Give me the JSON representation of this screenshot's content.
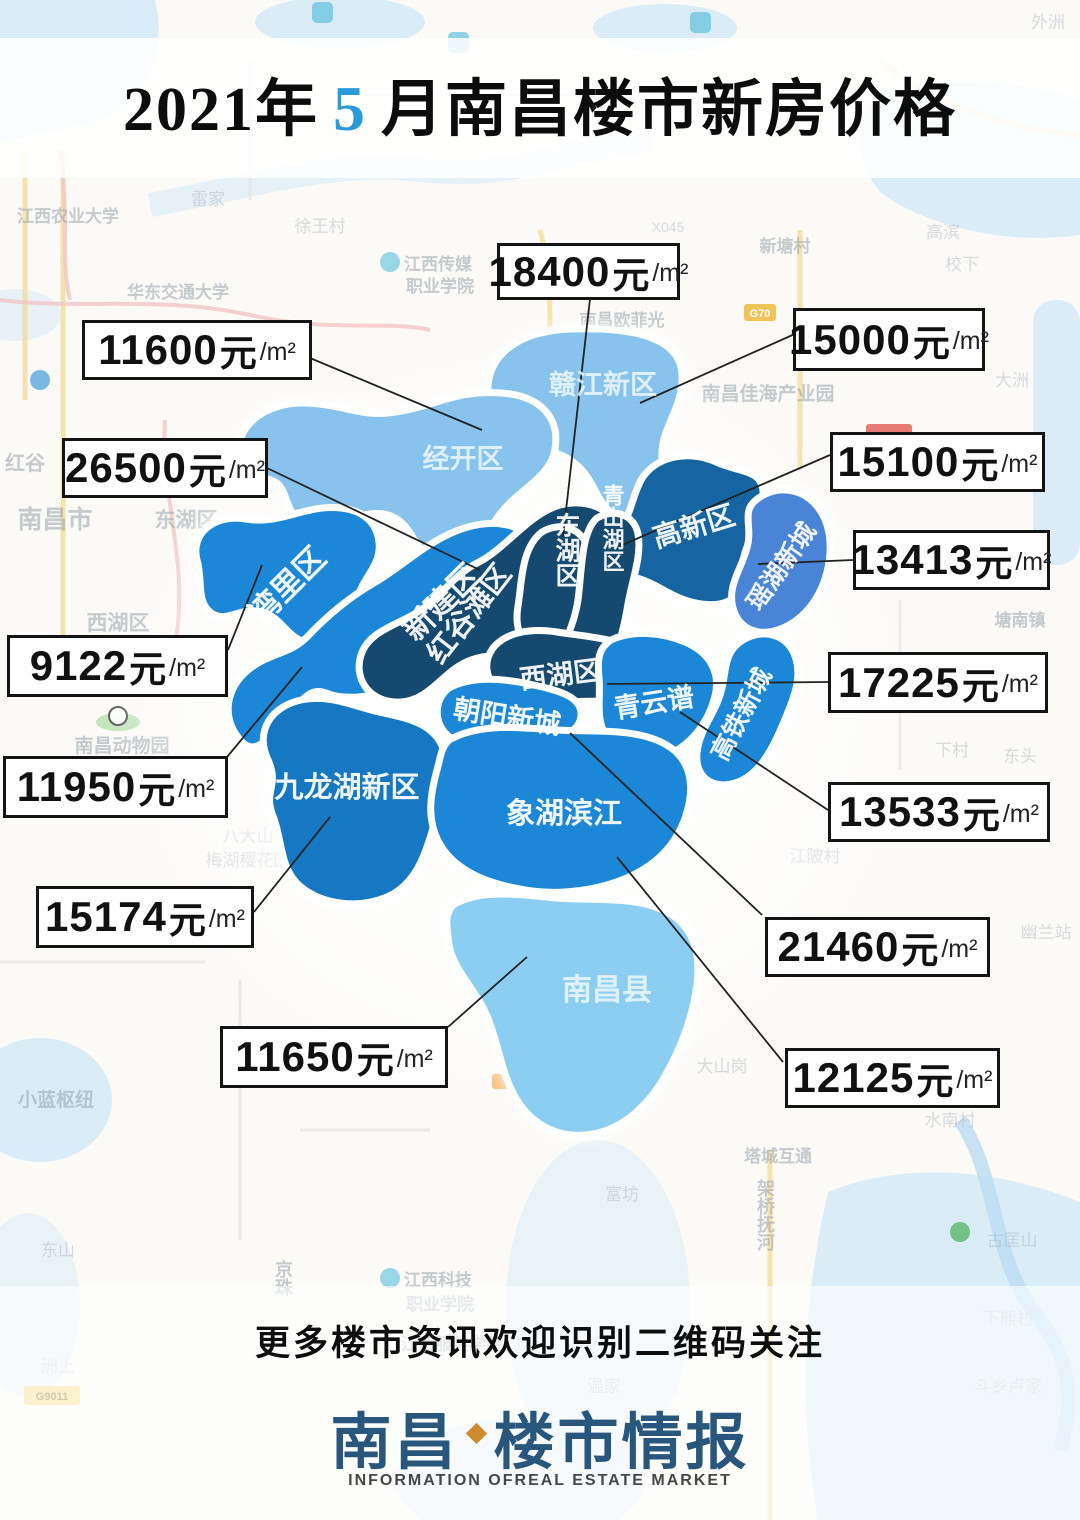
{
  "title": {
    "year": "2021年",
    "month": "5",
    "suffix": "月南昌楼市新房价格"
  },
  "units": {
    "yuan": "元",
    "per": "/m²"
  },
  "palette": {
    "light_blue": "#87c3ec",
    "county_blue": "#8ccdf2",
    "medium_blue": "#1d87d6",
    "deep_blue": "#1678c2",
    "steel_blue": "#1565a2",
    "royal_blue": "#4a84d6",
    "dark_navy": "#154a70",
    "title_month_blue": "#2b9ad8",
    "logo_blue": "#28567c",
    "logo_diamond_orange": "#cd8a2f"
  },
  "districts": [
    {
      "name": "赣江新区"
    },
    {
      "name": "经开区"
    },
    {
      "name": "湾里区"
    },
    {
      "name": "新建区"
    },
    {
      "name": "红谷滩区"
    },
    {
      "name": "东湖区"
    },
    {
      "name": "青山湖区"
    },
    {
      "name": "高新区"
    },
    {
      "name": "瑶湖新城"
    },
    {
      "name": "西湖区"
    },
    {
      "name": "青云谱"
    },
    {
      "name": "高铁新城"
    },
    {
      "name": "朝阳新城"
    },
    {
      "name": "九龙湖新区"
    },
    {
      "name": "象湖滨江"
    },
    {
      "name": "南昌县"
    }
  ],
  "price_labels": [
    {
      "value": "18400",
      "district": "东湖区"
    },
    {
      "value": "15000",
      "district": "赣江新区"
    },
    {
      "value": "11600",
      "district": "经开区"
    },
    {
      "value": "26500",
      "district": "红谷滩区"
    },
    {
      "value": "15100",
      "district": "青山湖区"
    },
    {
      "value": "13413",
      "district": "瑶湖新城"
    },
    {
      "value": "9122",
      "district": "湾里区"
    },
    {
      "value": "17225",
      "district": "西湖区"
    },
    {
      "value": "11950",
      "district": "新建区"
    },
    {
      "value": "13533",
      "district": "青云谱"
    },
    {
      "value": "15174",
      "district": "九龙湖新区"
    },
    {
      "value": "21460",
      "district": "朝阳新城"
    },
    {
      "value": "11650",
      "district": "南昌县"
    },
    {
      "value": "12125",
      "district": "象湖滨江"
    }
  ],
  "footer": {
    "slogan": "更多楼市资讯欢迎识别二维码关注",
    "logo_left": "南昌",
    "logo_right": "楼市情报",
    "tagline": "INFORMATION OFREAL ESTATE MARKET"
  },
  "badges": {
    "g70": "G70",
    "g9011": "G9011"
  },
  "bg_labels": [
    {
      "text": "江西农业大学"
    },
    {
      "text": "华东交通大学"
    },
    {
      "text": "雷家"
    },
    {
      "text": "徐王村"
    },
    {
      "text": "江西传媒"
    },
    {
      "text": "职业学院"
    },
    {
      "text": "南昌欧菲光"
    },
    {
      "text": "新塘村"
    },
    {
      "text": "X045"
    },
    {
      "text": "高滨"
    },
    {
      "text": "校下"
    },
    {
      "text": "南昌佳海产业园"
    },
    {
      "text": "大洲"
    },
    {
      "text": "杭长高速"
    },
    {
      "text": "南昌市"
    },
    {
      "text": "东湖区"
    },
    {
      "text": "西湖区"
    },
    {
      "text": "红谷"
    },
    {
      "text": "塘南镇"
    },
    {
      "text": "南昌动物园"
    },
    {
      "text": "下村"
    },
    {
      "text": "东头"
    },
    {
      "text": "江陂村"
    },
    {
      "text": "幽兰站"
    },
    {
      "text": "八大山"
    },
    {
      "text": "梅湖樱花园"
    },
    {
      "text": "小蓝枢纽"
    },
    {
      "text": "大山岗"
    },
    {
      "text": "塔城互通"
    },
    {
      "text": "水南村"
    },
    {
      "text": "古匡山"
    },
    {
      "text": "下熊村"
    },
    {
      "text": "架桥抚河"
    },
    {
      "text": "京珠"
    },
    {
      "text": "东山"
    },
    {
      "text": "洲上"
    },
    {
      "text": "江西科技"
    },
    {
      "text": "职业学院"
    },
    {
      "text": "江西服装学院"
    },
    {
      "text": "温家"
    },
    {
      "text": "斗乡卢家"
    },
    {
      "text": "富坊"
    },
    {
      "text": "外洲"
    }
  ]
}
